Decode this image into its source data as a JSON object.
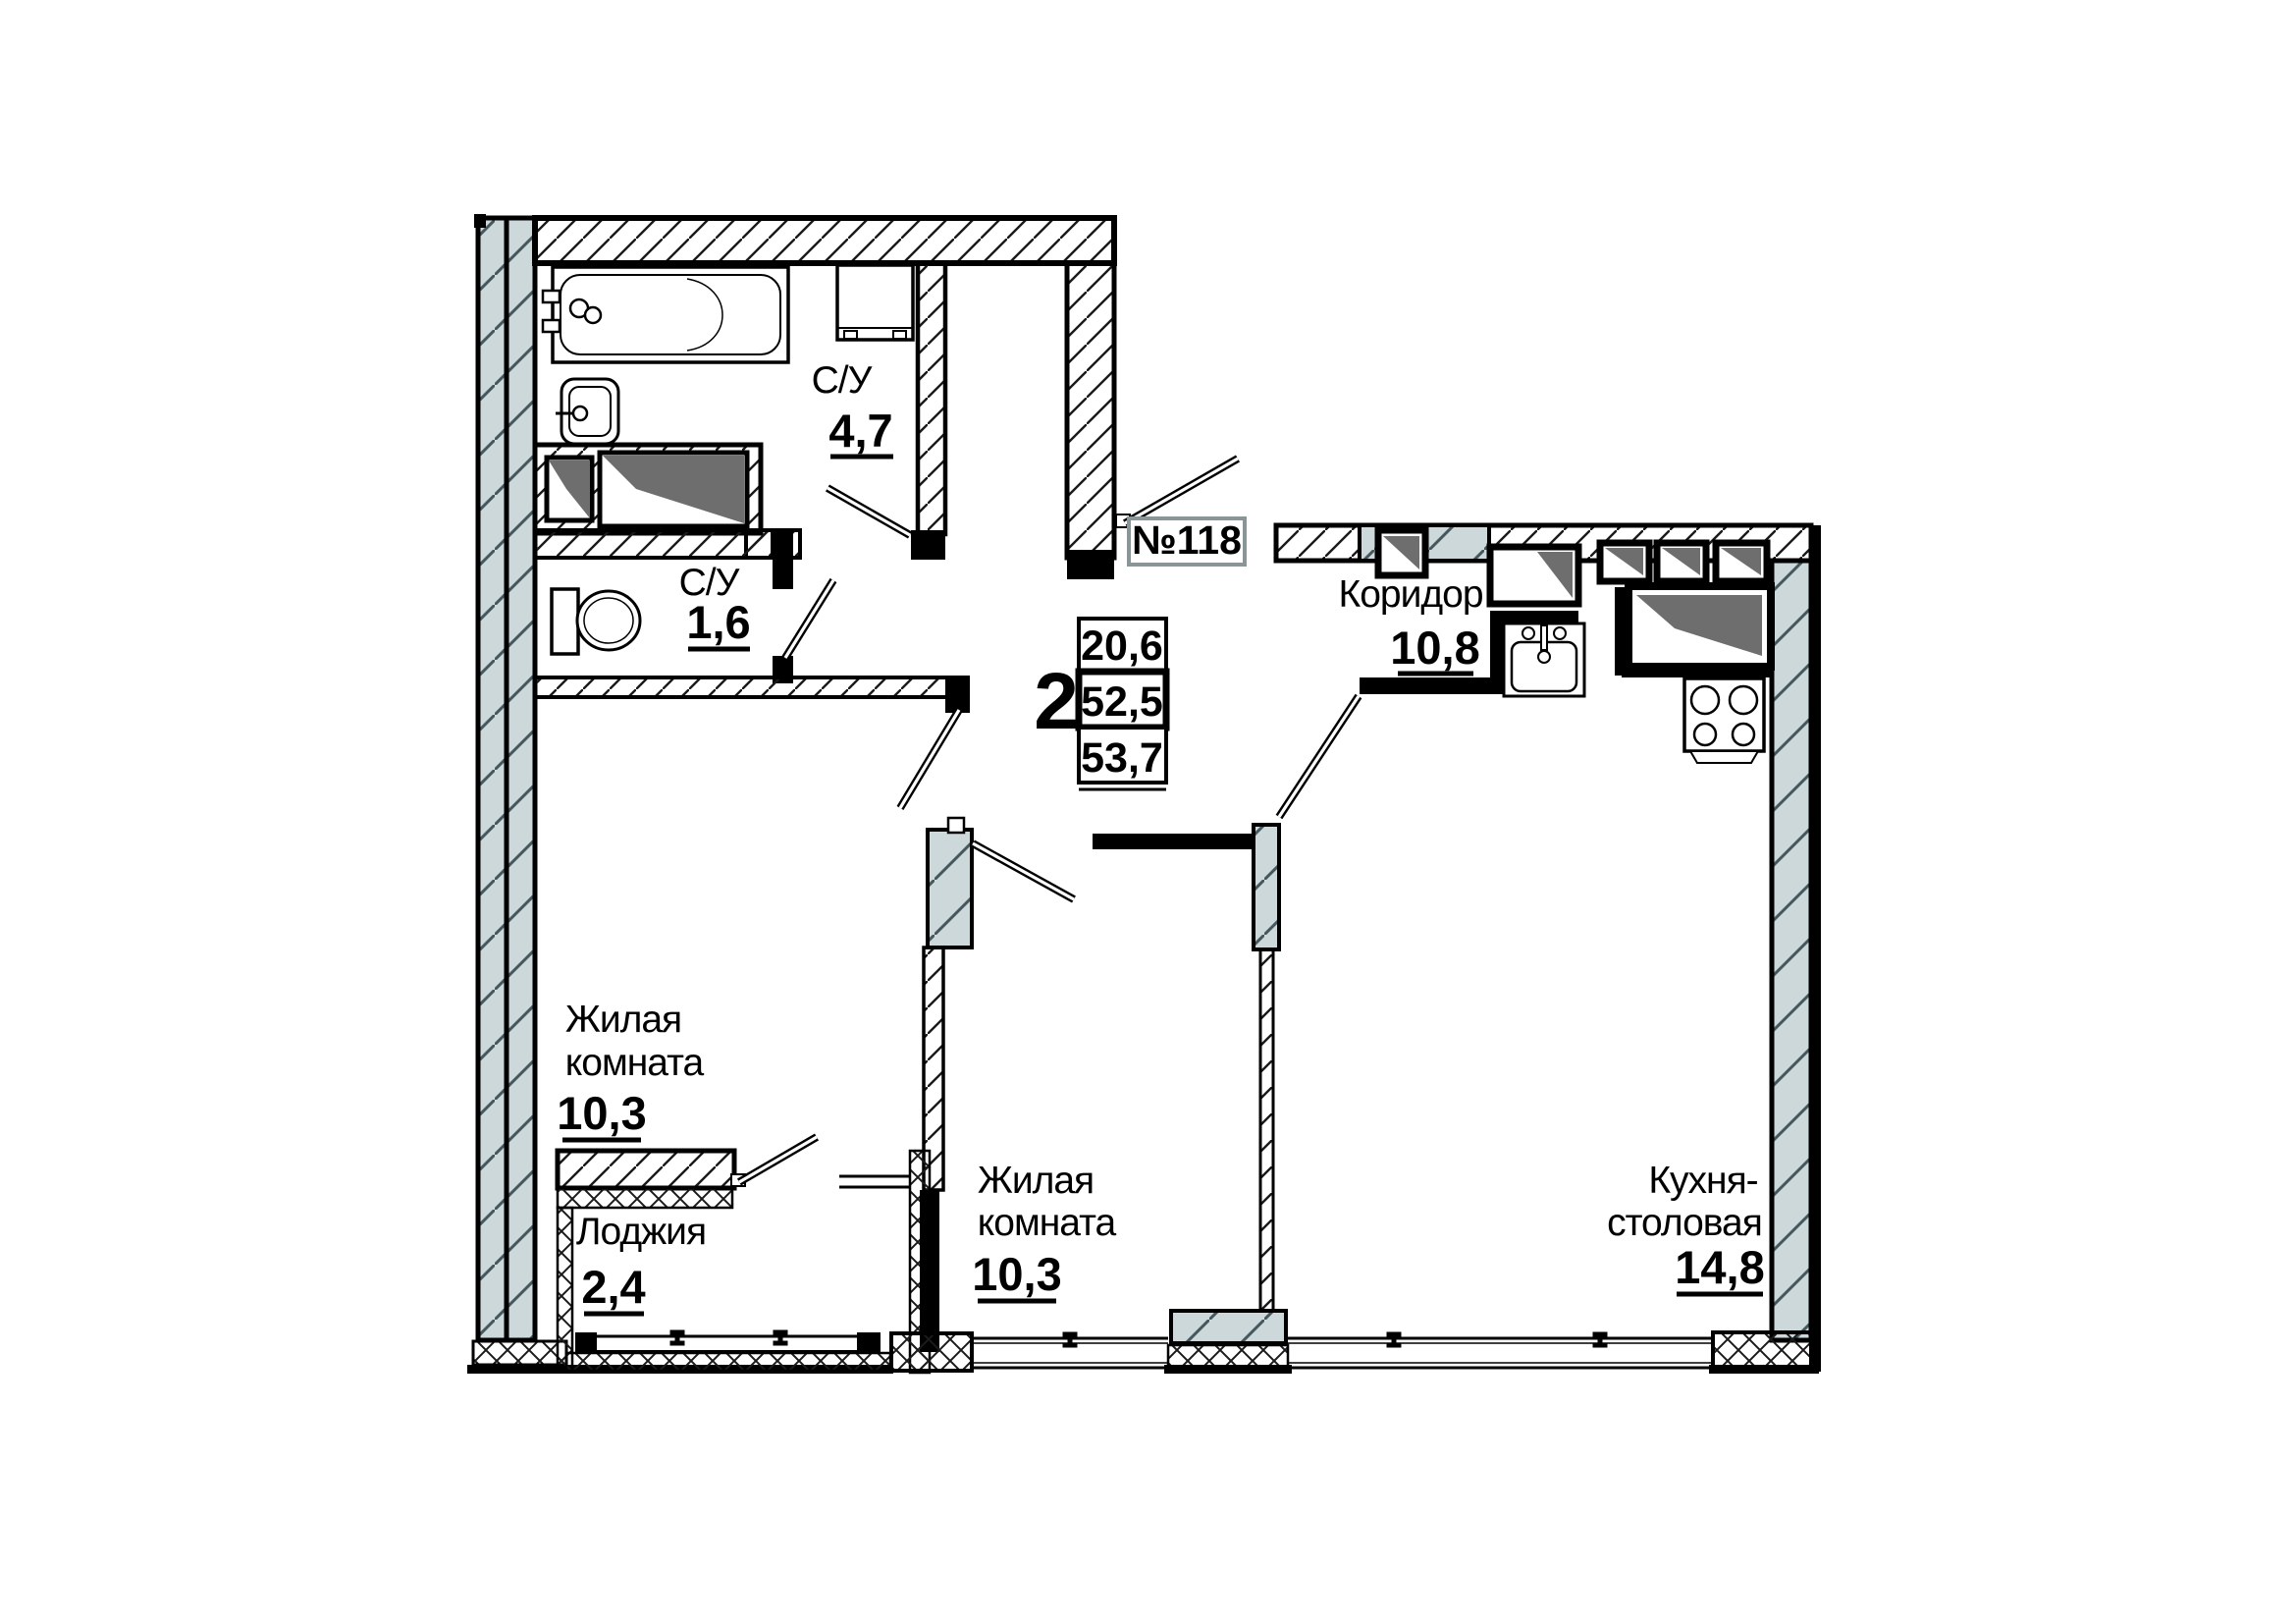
{
  "apartment": {
    "number": "№118",
    "rooms_count": "2",
    "area_living": "20,6",
    "area_usable": "52,5",
    "area_total": "53,7"
  },
  "rooms": {
    "bathroom": {
      "name": "С/У",
      "area": "4,7"
    },
    "wc": {
      "name": "С/У",
      "area": "1,6"
    },
    "corridor": {
      "name": "Коридор",
      "area": "10,8"
    },
    "living1": {
      "name1": "Жилая",
      "name2": "комната",
      "area": "10,3"
    },
    "living2": {
      "name1": "Жилая",
      "name2": "комната",
      "area": "10,3"
    },
    "loggia": {
      "name": "Лоджия",
      "area": "2,4"
    },
    "kitchen": {
      "name1": "Кухня-",
      "name2": "столовая",
      "area": "14,8"
    }
  },
  "colors": {
    "wall_gray": "#cdd8da",
    "vent_shade": "#6e6e6e",
    "number_box_border": "#8a9597",
    "line": "#000000"
  }
}
